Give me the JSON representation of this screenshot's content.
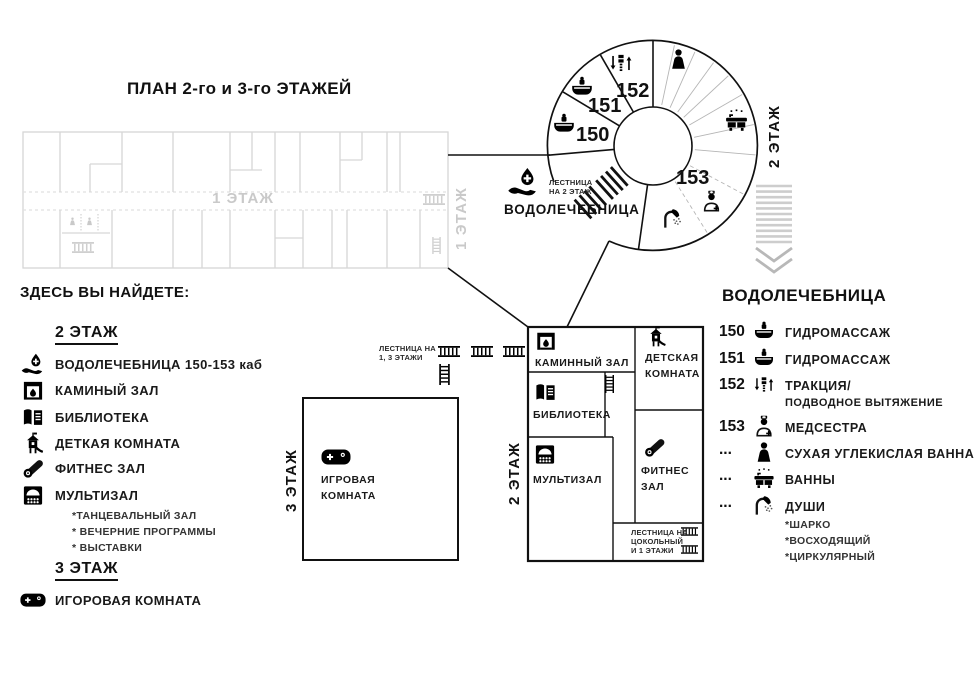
{
  "title": "ПЛАН 2-го и 3-го ЭТАЖЕЙ",
  "floor1_plan": {
    "corridor_label": "1 ЭТАЖ",
    "side_label": "1 ЭТАЖ"
  },
  "tower": {
    "rooms": {
      "r150": "150",
      "r151": "151",
      "r152": "152",
      "r153": "153"
    },
    "side_label": "2 ЭТАЖ",
    "stairs_note_line1": "ЛЕСТНИЦА",
    "stairs_note_line2": "НА 2 ЭТАЖ",
    "area_label": "ВОДОЛЕЧЕБНИЦА",
    "icons": {
      "hydro150": "hydro-tub-icon",
      "hydro151": "hydro-tub-icon",
      "traction": "traction-icon",
      "person": "person-icon",
      "bath": "bath-icon",
      "nurse": "nurse-icon",
      "shower": "shower-icon",
      "entry": "water-hand-icon"
    }
  },
  "floor3_plan": {
    "side_label": "3 ЭТАЖ",
    "room_line1": "ИГРОВАЯ",
    "room_line2": "КОМНАТА",
    "room_icon": "gamepad-icon"
  },
  "stairs13_note": {
    "line1": "ЛЕСТНИЦА НА",
    "line2": "1, 3 ЭТАЖИ"
  },
  "floor2_plan": {
    "side_label": "2 ЭТАЖ",
    "rooms": {
      "fireplace": "КАМИННЫЙ ЗАЛ",
      "kids_line1": "ДЕТСКАЯ",
      "kids_line2": "КОМНАТА",
      "library": "БИБЛИОТЕКА",
      "multihall": "МУЛЬТИЗАЛ",
      "fitness_line1": "ФИТНЕС",
      "fitness_line2": "ЗАЛ"
    },
    "icons": {
      "fireplace": "fireplace-icon",
      "kids": "kids-tower-icon",
      "library": "library-icon",
      "multihall": "multihall-icon",
      "fitness": "fitness-mat-icon"
    },
    "stairs_note": {
      "line1": "ЛЕСТНИЦА НА",
      "line2": "ЦОКОЛЬНЫЙ",
      "line3": "И 1 ЭТАЖИ"
    }
  },
  "stairs_icons": {
    "h": "stairs-h-icon",
    "v": "ladder-v-icon",
    "person": "person-icon"
  },
  "legend_left": {
    "heading": "ЗДЕСЬ ВЫ НАЙДЕТЕ:",
    "floor2_heading": "2 ЭТАЖ",
    "items": [
      {
        "icon": "water-hand-icon",
        "label": "ВОДОЛЕЧЕБНИЦА 150-153 каб"
      },
      {
        "icon": "fireplace-icon",
        "label": "КАМИНЫЙ ЗАЛ"
      },
      {
        "icon": "library-icon",
        "label": "БИБЛИОТЕКА"
      },
      {
        "icon": "kids-tower-icon",
        "label": "ДЕТКАЯ КОМНАТА"
      },
      {
        "icon": "fitness-mat-icon",
        "label": "ФИТНЕС ЗАЛ"
      },
      {
        "icon": "multihall-icon",
        "label": "МУЛЬТИЗАЛ",
        "notes": [
          "*ТАНЦЕВАЛЬНЫЙ ЗАЛ",
          "* ВЕЧЕРНИЕ ПРОГРАММЫ",
          "* ВЫСТАВКИ"
        ]
      }
    ],
    "floor3_heading": "3 ЭТАЖ",
    "floor3_item": {
      "icon": "gamepad-icon",
      "label": "ИГОРОВАЯ КОМНАТА"
    }
  },
  "legend_right": {
    "heading": "ВОДОЛЕЧЕБНИЦА",
    "items": [
      {
        "num": "150",
        "icon": "hydro-tub-icon",
        "label": "ГИДРОМАССАЖ"
      },
      {
        "num": "151",
        "icon": "hydro-tub-icon",
        "label": "ГИДРОМАССАЖ"
      },
      {
        "num": "152",
        "icon": "traction-icon",
        "label": "ТРАКЦИЯ/",
        "label2": "ПОДВОДНОЕ ВЫТЯЖЕНИЕ"
      },
      {
        "num": "153",
        "icon": "nurse-icon",
        "label": "МЕДСЕСТРА"
      },
      {
        "num": "...",
        "icon": "person-icon",
        "label": "СУХАЯ УГЛЕКИСЛАЯ ВАННА"
      },
      {
        "num": "...",
        "icon": "bath-icon",
        "label": "ВАННЫ"
      },
      {
        "num": "...",
        "icon": "shower-icon",
        "label": "ДУШИ",
        "notes": [
          "*ШАРКО",
          "*ВОСХОДЯЩИЙ",
          "*ЦИРКУЛЯРНЫЙ"
        ]
      }
    ]
  },
  "colors": {
    "ink": "#111111",
    "faint": "#d6d6d6",
    "fan_lines": "#b5b5b5",
    "arrow": "#c9c9c9"
  }
}
